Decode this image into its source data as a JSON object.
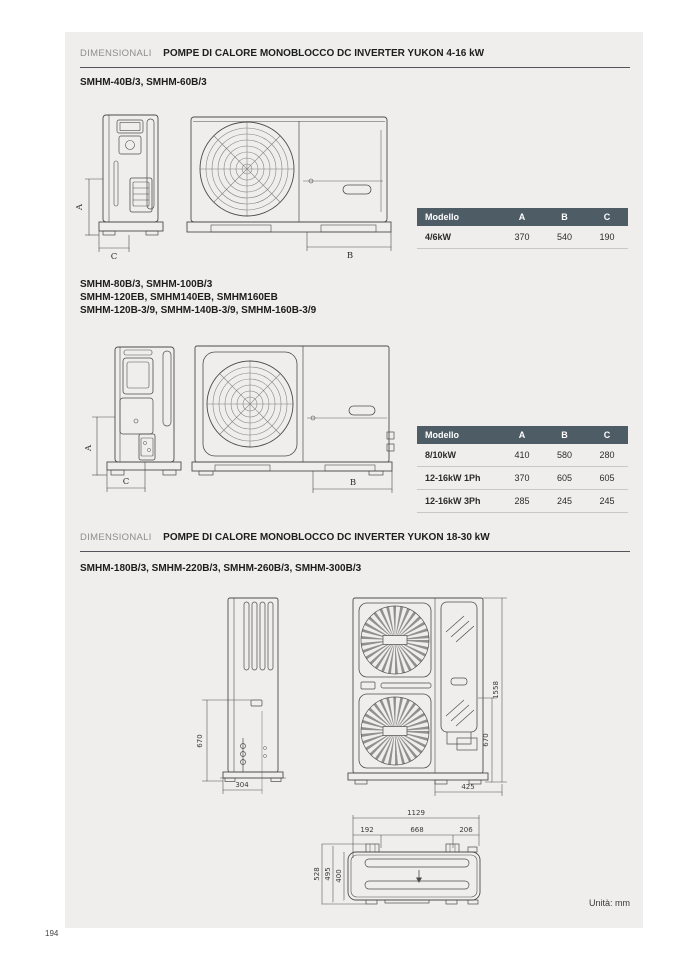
{
  "page": {
    "number": "194",
    "units_note": "Unità: mm",
    "accent_color": "#4e5c66",
    "panel_bg": "#efeeec"
  },
  "section1": {
    "kicker": "DIMENSIONALI",
    "title": "POMPE DI CALORE MONOBLOCCO DC INVERTER YUKON 4-16 kW",
    "models": "SMHM-40B/3, SMHM-60B/3",
    "drawing_dims": {
      "a": "A",
      "b": "B",
      "c": "C"
    },
    "table": {
      "headers": [
        "Modello",
        "A",
        "B",
        "C"
      ],
      "rows": [
        {
          "model": "4/6kW",
          "a": "370",
          "b": "540",
          "c": "190"
        }
      ]
    }
  },
  "section2": {
    "models_line1": "SMHM-80B/3, SMHM-100B/3",
    "models_line2": "SMHM-120EB, SMHM140EB, SMHM160EB",
    "models_line3": "SMHM-120B-3/9, SMHM-140B-3/9, SMHM-160B-3/9",
    "drawing_dims": {
      "a": "A",
      "b": "B",
      "c": "C"
    },
    "table": {
      "headers": [
        "Modello",
        "A",
        "B",
        "C"
      ],
      "rows": [
        {
          "model": "8/10kW",
          "a": "410",
          "b": "580",
          "c": "280"
        },
        {
          "model": "12-16kW 1Ph",
          "a": "370",
          "b": "605",
          "c": "605"
        },
        {
          "model": "12-16kW 3Ph",
          "a": "285",
          "b": "245",
          "c": "245"
        }
      ]
    }
  },
  "section3": {
    "kicker": "DIMENSIONALI",
    "title": "POMPE DI CALORE MONOBLOCCO DC INVERTER YUKON 18-30 kW",
    "models": "SMHM-180B/3, SMHM-220B/3, SMHM-260B/3, SMHM-300B/3",
    "drawing_dims": {
      "side_height": "670",
      "side_depth": "304",
      "front_height_total": "1558",
      "front_height_partial": "670",
      "front_width_partial": "425",
      "top_width_total": "1129",
      "top_seg_left": "192",
      "top_seg_center": "668",
      "top_seg_right": "206",
      "top_depth_outer": "528",
      "top_depth_mid": "495",
      "top_depth_inner": "400"
    }
  }
}
